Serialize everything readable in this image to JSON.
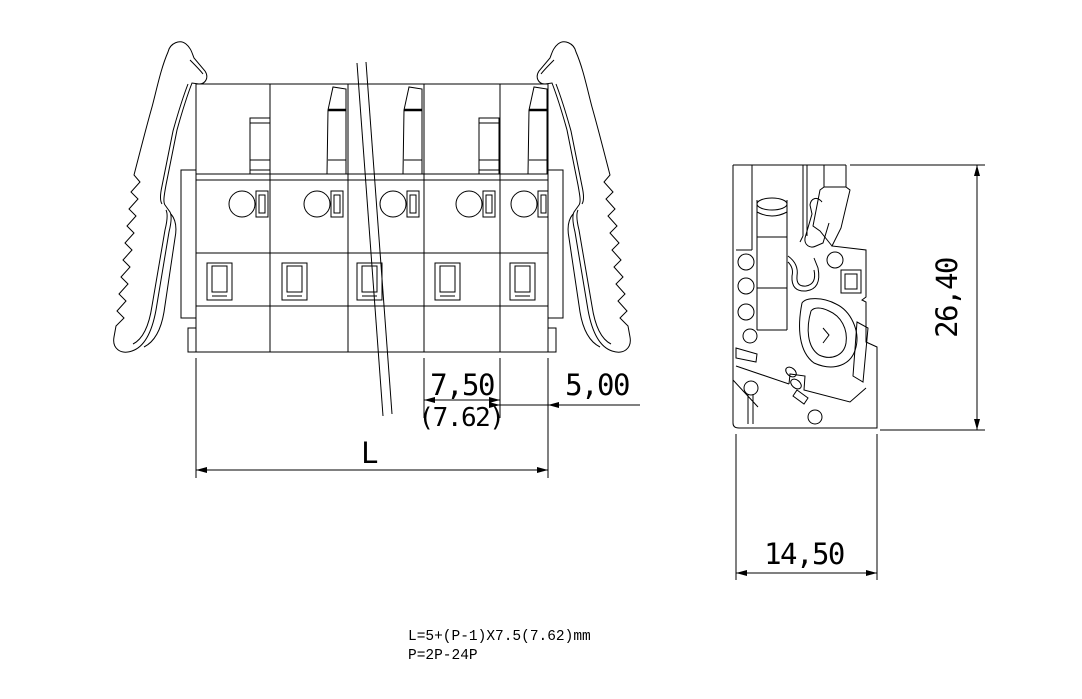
{
  "drawing": {
    "type": "technical-drawing",
    "subject": "pluggable screwless terminal block - front view and side profile view",
    "colors": {
      "line": "#000000",
      "background": "#ffffff"
    },
    "front_view": {
      "poles_shown": "5",
      "dimensions": {
        "pitch": "7,50",
        "pitch_alt": "(7.62)",
        "end_offset": "5,00",
        "length_label": "L"
      }
    },
    "side_view": {
      "dimensions": {
        "height": "26,40",
        "depth": "14,50"
      }
    },
    "notes": {
      "line1": "L=5+(P-1)X7.5(7.62)mm",
      "line2": "P=2P-24P"
    }
  }
}
